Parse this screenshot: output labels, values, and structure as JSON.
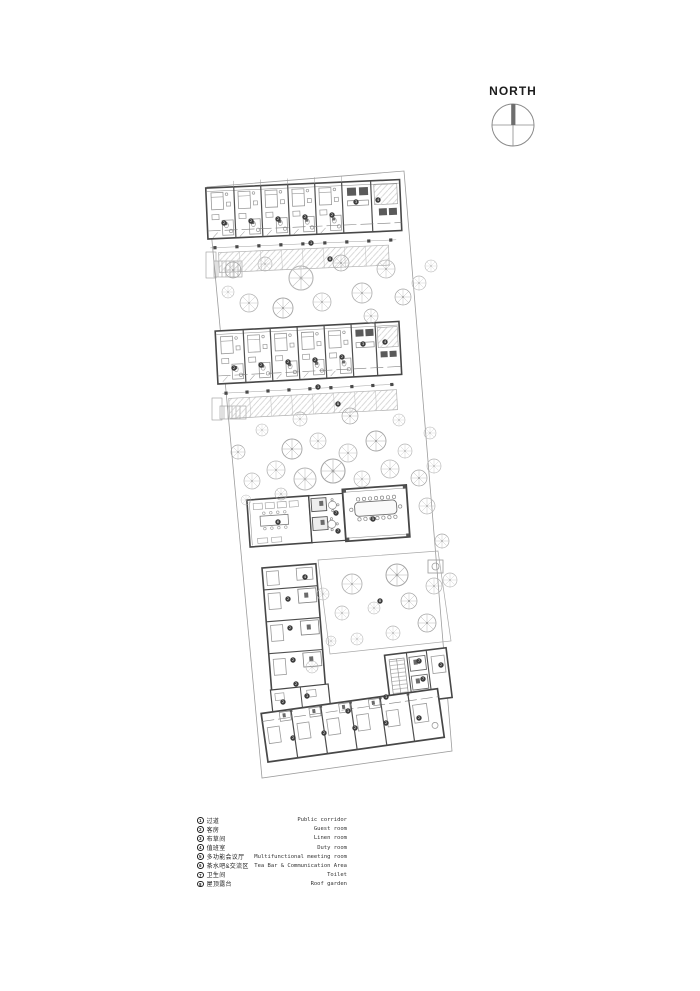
{
  "compass": {
    "label": "NORTH"
  },
  "legend": {
    "items": [
      {
        "num": "1",
        "zh": "过道",
        "en": "Public corridor"
      },
      {
        "num": "2",
        "zh": "客房",
        "en": "Guest room"
      },
      {
        "num": "3",
        "zh": "布草间",
        "en": "Linen room"
      },
      {
        "num": "4",
        "zh": "值班室",
        "en": "Duty room"
      },
      {
        "num": "5",
        "zh": "多功能会议厅",
        "en": "Multifunctional meeting room"
      },
      {
        "num": "6",
        "zh": "茶水吧&交流区",
        "en": "Tea Bar & Communication Area"
      },
      {
        "num": "7",
        "zh": "卫生间",
        "en": "Toilet"
      },
      {
        "num": "8",
        "zh": "屋顶露台",
        "en": "Roof garden"
      }
    ]
  },
  "colors": {
    "wall": "#474747",
    "light": "#8f8f8f",
    "tree": "#b4b4b4",
    "marker": "#3d3d3d"
  },
  "plan": {
    "markers": [
      {
        "n": "2",
        "x": 224,
        "y": 223
      },
      {
        "n": "2",
        "x": 251,
        "y": 221
      },
      {
        "n": "2",
        "x": 278,
        "y": 219
      },
      {
        "n": "2",
        "x": 305,
        "y": 217
      },
      {
        "n": "2",
        "x": 332,
        "y": 215
      },
      {
        "n": "3",
        "x": 356,
        "y": 202
      },
      {
        "n": "4",
        "x": 378,
        "y": 200
      },
      {
        "n": "1",
        "x": 311,
        "y": 243
      },
      {
        "n": "8",
        "x": 330,
        "y": 259
      },
      {
        "n": "2",
        "x": 234,
        "y": 368
      },
      {
        "n": "2",
        "x": 261,
        "y": 365
      },
      {
        "n": "2",
        "x": 288,
        "y": 362
      },
      {
        "n": "2",
        "x": 315,
        "y": 360
      },
      {
        "n": "2",
        "x": 342,
        "y": 357
      },
      {
        "n": "3",
        "x": 363,
        "y": 344
      },
      {
        "n": "4",
        "x": 385,
        "y": 342
      },
      {
        "n": "1",
        "x": 318,
        "y": 387
      },
      {
        "n": "8",
        "x": 338,
        "y": 404
      },
      {
        "n": "6",
        "x": 278,
        "y": 522
      },
      {
        "n": "7",
        "x": 336,
        "y": 513
      },
      {
        "n": "7",
        "x": 338,
        "y": 531
      },
      {
        "n": "5",
        "x": 373,
        "y": 519
      },
      {
        "n": "4",
        "x": 305,
        "y": 577
      },
      {
        "n": "2",
        "x": 288,
        "y": 599
      },
      {
        "n": "2",
        "x": 290,
        "y": 628
      },
      {
        "n": "2",
        "x": 293,
        "y": 660
      },
      {
        "n": "2",
        "x": 296,
        "y": 684
      },
      {
        "n": "8",
        "x": 380,
        "y": 601
      },
      {
        "n": "7",
        "x": 419,
        "y": 661
      },
      {
        "n": "7",
        "x": 423,
        "y": 679
      },
      {
        "n": "2",
        "x": 441,
        "y": 665
      },
      {
        "n": "1",
        "x": 386,
        "y": 697
      },
      {
        "n": "2",
        "x": 283,
        "y": 702
      },
      {
        "n": "1",
        "x": 307,
        "y": 696
      },
      {
        "n": "2",
        "x": 293,
        "y": 738
      },
      {
        "n": "2",
        "x": 324,
        "y": 733
      },
      {
        "n": "2",
        "x": 355,
        "y": 728
      },
      {
        "n": "2",
        "x": 386,
        "y": 723
      },
      {
        "n": "2",
        "x": 419,
        "y": 718
      },
      {
        "n": "1",
        "x": 348,
        "y": 711
      }
    ],
    "trees": [
      [
        233,
        270,
        8
      ],
      [
        249,
        303,
        9
      ],
      [
        265,
        264,
        7
      ],
      [
        283,
        308,
        10
      ],
      [
        301,
        278,
        12
      ],
      [
        322,
        302,
        9
      ],
      [
        341,
        263,
        8
      ],
      [
        362,
        293,
        10
      ],
      [
        386,
        269,
        9
      ],
      [
        403,
        297,
        8
      ],
      [
        419,
        283,
        7
      ],
      [
        431,
        266,
        6
      ],
      [
        371,
        316,
        7
      ],
      [
        228,
        292,
        6
      ],
      [
        262,
        430,
        6
      ],
      [
        238,
        452,
        7
      ],
      [
        252,
        481,
        8
      ],
      [
        276,
        470,
        9
      ],
      [
        292,
        449,
        10
      ],
      [
        305,
        479,
        11
      ],
      [
        318,
        441,
        8
      ],
      [
        333,
        471,
        12
      ],
      [
        348,
        453,
        9
      ],
      [
        362,
        479,
        8
      ],
      [
        376,
        441,
        10
      ],
      [
        390,
        469,
        9
      ],
      [
        405,
        451,
        7
      ],
      [
        419,
        478,
        8
      ],
      [
        430,
        433,
        6
      ],
      [
        300,
        419,
        7
      ],
      [
        350,
        416,
        8
      ],
      [
        399,
        420,
        6
      ],
      [
        434,
        466,
        7
      ],
      [
        281,
        494,
        6
      ],
      [
        246,
        500,
        5
      ],
      [
        427,
        506,
        8
      ],
      [
        442,
        541,
        7
      ],
      [
        450,
        580,
        7
      ],
      [
        352,
        584,
        10
      ],
      [
        397,
        575,
        11
      ],
      [
        342,
        613,
        7
      ],
      [
        374,
        608,
        6
      ],
      [
        409,
        601,
        8
      ],
      [
        357,
        639,
        6
      ],
      [
        393,
        633,
        7
      ],
      [
        427,
        623,
        9
      ],
      [
        434,
        586,
        8
      ],
      [
        323,
        594,
        6
      ],
      [
        331,
        641,
        5
      ],
      [
        312,
        667,
        6
      ]
    ]
  }
}
